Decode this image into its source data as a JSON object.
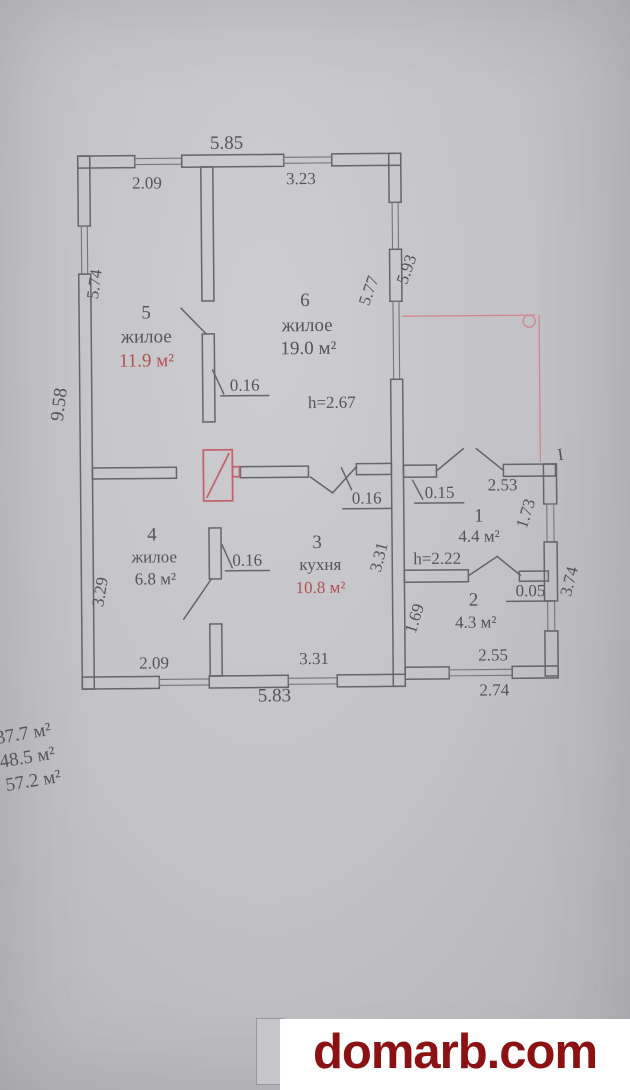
{
  "colors": {
    "paper_gray": "#c4c4c8",
    "ink_gray": "#53545a",
    "plan_red": "#c4636e",
    "red_text": "#b25150",
    "watermark_red": "#8c1113"
  },
  "plan": {
    "rooms": {
      "r5": {
        "number": "5",
        "label": "жилое",
        "area": "11.9 м²"
      },
      "r6": {
        "number": "6",
        "label": "жилое",
        "area": "19.0 м²"
      },
      "r4": {
        "number": "4",
        "label": "жилое",
        "area": "6.8 м²"
      },
      "r3": {
        "number": "3",
        "label": "кухня",
        "area": "10.8 м²"
      },
      "r1": {
        "number": "1",
        "area": "4.4 м²"
      },
      "r2": {
        "number": "2",
        "area": "4.3 м²"
      }
    },
    "heights": {
      "main": "h=2.67",
      "annex": "h=2.22"
    },
    "dims": {
      "top_width": "5.85",
      "top_room5": "2.09",
      "top_room6": "3.23",
      "left_total": "9.58",
      "left_room5": "5.74",
      "right_room6_inner": "5.77",
      "right_room6_outer": "5.93",
      "door_rooms56": "0.16",
      "door_kitchen": "0.16",
      "door_room4": "0.16",
      "door_hall": "0.15",
      "door_room2": "0.05",
      "hall_top": "2.53",
      "hall_right": "1.73",
      "left_room4": "3.29",
      "kitchen_right": "3.31",
      "room2_left": "1.69",
      "annex_right": "3.74",
      "room2_bottom_inner": "2.55",
      "annex_bottom_outer": "2.74",
      "bottom_room4": "2.09",
      "bottom_kitchen": "3.31",
      "bottom_width": "5.83",
      "porch_mark": "I"
    },
    "totals": {
      "line1": "37.7 м²",
      "line2": "48.5 м²",
      "line3": "57.2 м²"
    }
  },
  "watermark": {
    "text": "domarb.com"
  }
}
